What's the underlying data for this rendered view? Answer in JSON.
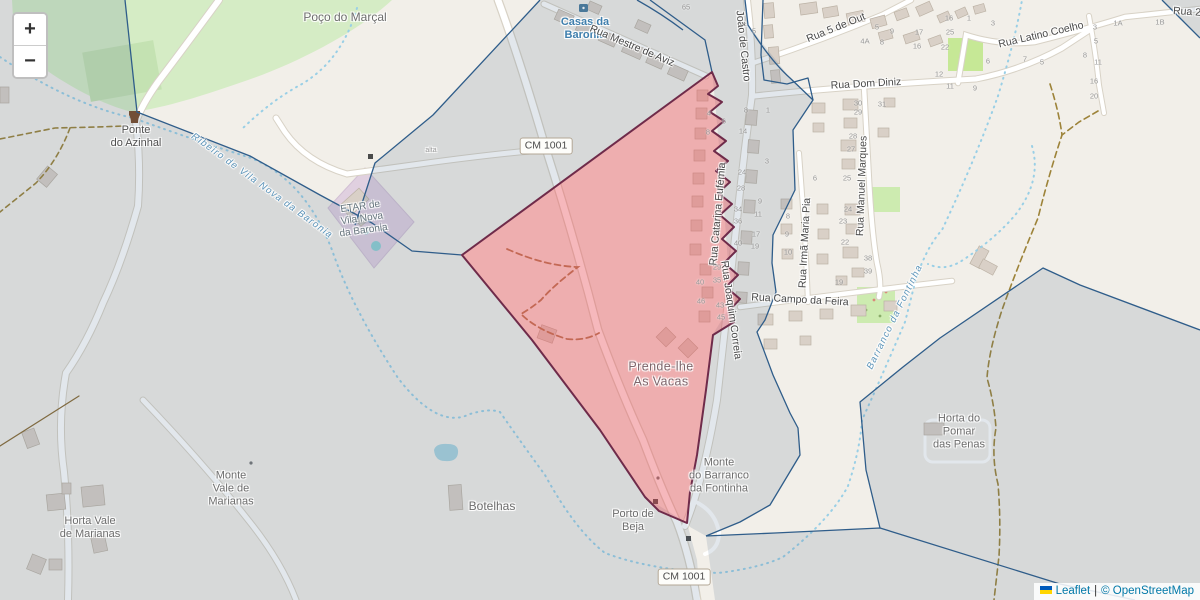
{
  "zoom_control": {
    "zoom_in": "+",
    "zoom_out": "−"
  },
  "attribution": {
    "leaflet_link": "Leaflet",
    "separator": "|",
    "osm_link": "© OpenStreetMap"
  },
  "colors": {
    "selected_fill": "#e74d57",
    "selected_stroke": "#6f2b4a",
    "boundary": "#2f5d8a",
    "tint": "rgba(77,107,137,0.16)",
    "water": "#99cfe6",
    "link": "#0078A8",
    "flag_blue": "#005BBB",
    "flag_yellow": "#FFD500"
  },
  "labels": [
    {
      "name": "poco-do-marcal",
      "text": "Poço do Marçal",
      "x": 345,
      "y": 17,
      "cls": "place"
    },
    {
      "name": "ponte-do-azinhal",
      "text": "Ponte\ndo Azinhal",
      "x": 136,
      "y": 137,
      "cls": "place-sm dark"
    },
    {
      "name": "casas-da-baronia",
      "text": "Casas da\nBaronia",
      "x": 585,
      "y": 29,
      "cls": "water-place"
    },
    {
      "name": "prende-lhe-as-vacas",
      "text": "Prende-lhe\nAs Vacas",
      "x": 661,
      "y": 374,
      "cls": "area"
    },
    {
      "name": "monte-do-barranco-da-fontinha",
      "text": "Monte\ndo Barranco\nda Fontinha",
      "x": 719,
      "y": 476,
      "cls": "place-sm"
    },
    {
      "name": "porto-de-beja",
      "text": "Porto de\nBeja",
      "x": 633,
      "y": 521,
      "cls": "place-sm"
    },
    {
      "name": "botelhas",
      "text": "Botelhas",
      "x": 492,
      "y": 506,
      "cls": "place"
    },
    {
      "name": "monte-vale-de-marianas",
      "text": "Monte\nVale de\nMarianas",
      "x": 231,
      "y": 489,
      "cls": "place-sm"
    },
    {
      "name": "horta-vale-de-marianas",
      "text": "Horta Vale\nde Marianas",
      "x": 90,
      "y": 528,
      "cls": "place-sm"
    },
    {
      "name": "horta-do-pomar-das-penas",
      "text": "Horta do\nPomar\ndas Penas",
      "x": 959,
      "y": 432,
      "cls": "place-sm"
    },
    {
      "name": "etar-de-vila-nova-da-baronia",
      "text": "ETAR de\nVila Nova\nda Baronia",
      "x": 362,
      "y": 219,
      "cls": "etar",
      "rot": -8
    },
    {
      "name": "ribeiro-de-vila-nova-da-baronia",
      "text": "Ribeiro de Vila Nova da Baronia",
      "x": 262,
      "y": 186,
      "cls": "water",
      "rot": 36
    },
    {
      "name": "barranco-da-fontinha",
      "text": "Barranco da Fontinha",
      "x": 895,
      "y": 317,
      "cls": "water",
      "rot": -64
    },
    {
      "name": "rua-mestre-de-aviz",
      "text": "Rua Mestre de Aviz",
      "x": 632,
      "y": 46,
      "cls": "street",
      "rot": 23
    },
    {
      "name": "rua-joao-de-castro",
      "text": "João de Castro",
      "x": 743,
      "y": 46,
      "cls": "street",
      "rot": 84
    },
    {
      "name": "rua-5-de-outubro",
      "text": "Rua 5 de Out",
      "x": 836,
      "y": 28,
      "cls": "street",
      "rot": -22
    },
    {
      "name": "rua-dom-diniz",
      "text": "Rua Dom Diniz",
      "x": 866,
      "y": 84,
      "cls": "street",
      "rot": -3
    },
    {
      "name": "rua-latino-coelho",
      "text": "Rua Latino Coelho",
      "x": 1041,
      "y": 35,
      "cls": "street",
      "rot": -13
    },
    {
      "name": "rua-2",
      "text": "Rua 2",
      "x": 1187,
      "y": 12,
      "cls": "street",
      "rot": 4
    },
    {
      "name": "rua-catarina-eufemia",
      "text": "Rua Catarina Eufémia",
      "x": 718,
      "y": 214,
      "cls": "street",
      "rot": -85
    },
    {
      "name": "rua-joaquim-correia",
      "text": "Rua Joaquim Correia",
      "x": 731,
      "y": 310,
      "cls": "street",
      "rot": 82
    },
    {
      "name": "rua-irma-maria-pia",
      "text": "Rua Irmã Maria Pia",
      "x": 805,
      "y": 243,
      "cls": "street",
      "rot": -87
    },
    {
      "name": "rua-manuel-marques",
      "text": "Rua Manuel Marques",
      "x": 862,
      "y": 186,
      "cls": "street",
      "rot": -88
    },
    {
      "name": "rua-campo-da-feira",
      "text": "Rua Campo da Feira",
      "x": 800,
      "y": 300,
      "cls": "street",
      "rot": 3
    },
    {
      "name": "path-label-alta",
      "text": "alta",
      "x": 431,
      "y": 151,
      "cls": "tiny"
    },
    {
      "name": "road-shield-cm1001-north",
      "text": "CM 1001",
      "x": 546,
      "y": 146,
      "cls": "shield"
    },
    {
      "name": "road-shield-cm1001-south",
      "text": "CM 1001",
      "x": 684,
      "y": 577,
      "cls": "shield"
    }
  ],
  "house_numbers": [
    {
      "t": "65",
      "x": 686,
      "y": 8
    },
    {
      "t": "5",
      "x": 754,
      "y": 32
    },
    {
      "t": "4A",
      "x": 865,
      "y": 42
    },
    {
      "t": "4",
      "x": 709,
      "y": 114
    },
    {
      "t": "6",
      "x": 724,
      "y": 122
    },
    {
      "t": "8",
      "x": 708,
      "y": 133
    },
    {
      "t": "14",
      "x": 743,
      "y": 132
    },
    {
      "t": "8",
      "x": 746,
      "y": 111
    },
    {
      "t": "1",
      "x": 768,
      "y": 111
    },
    {
      "t": "3",
      "x": 767,
      "y": 162
    },
    {
      "t": "24",
      "x": 742,
      "y": 173
    },
    {
      "t": "28",
      "x": 741,
      "y": 189
    },
    {
      "t": "9",
      "x": 760,
      "y": 202
    },
    {
      "t": "11",
      "x": 758,
      "y": 215
    },
    {
      "t": "34",
      "x": 738,
      "y": 210
    },
    {
      "t": "36",
      "x": 738,
      "y": 222
    },
    {
      "t": "17",
      "x": 756,
      "y": 235
    },
    {
      "t": "19",
      "x": 755,
      "y": 247
    },
    {
      "t": "40",
      "x": 738,
      "y": 244
    },
    {
      "t": "8",
      "x": 788,
      "y": 217
    },
    {
      "t": "9",
      "x": 787,
      "y": 235
    },
    {
      "t": "10",
      "x": 788,
      "y": 253
    },
    {
      "t": "29",
      "x": 717,
      "y": 268
    },
    {
      "t": "35",
      "x": 717,
      "y": 281
    },
    {
      "t": "40",
      "x": 700,
      "y": 283
    },
    {
      "t": "46",
      "x": 701,
      "y": 302
    },
    {
      "t": "43",
      "x": 720,
      "y": 306
    },
    {
      "t": "45",
      "x": 721,
      "y": 318
    },
    {
      "t": "6",
      "x": 815,
      "y": 179
    },
    {
      "t": "25",
      "x": 847,
      "y": 179
    },
    {
      "t": "30",
      "x": 858,
      "y": 104
    },
    {
      "t": "29",
      "x": 858,
      "y": 113
    },
    {
      "t": "28",
      "x": 853,
      "y": 137
    },
    {
      "t": "27",
      "x": 851,
      "y": 150
    },
    {
      "t": "24",
      "x": 848,
      "y": 210
    },
    {
      "t": "23",
      "x": 843,
      "y": 222
    },
    {
      "t": "22",
      "x": 845,
      "y": 243
    },
    {
      "t": "19",
      "x": 839,
      "y": 283
    },
    {
      "t": "38",
      "x": 868,
      "y": 259
    },
    {
      "t": "39",
      "x": 868,
      "y": 272
    },
    {
      "t": "31",
      "x": 882,
      "y": 105
    },
    {
      "t": "16",
      "x": 949,
      "y": 19
    },
    {
      "t": "25",
      "x": 950,
      "y": 33
    },
    {
      "t": "22",
      "x": 945,
      "y": 48
    },
    {
      "t": "17",
      "x": 919,
      "y": 33
    },
    {
      "t": "9",
      "x": 892,
      "y": 32
    },
    {
      "t": "5",
      "x": 877,
      "y": 28
    },
    {
      "t": "8",
      "x": 882,
      "y": 43
    },
    {
      "t": "16",
      "x": 917,
      "y": 47
    },
    {
      "t": "12",
      "x": 939,
      "y": 75
    },
    {
      "t": "11",
      "x": 950,
      "y": 87
    },
    {
      "t": "9",
      "x": 975,
      "y": 89
    },
    {
      "t": "1",
      "x": 969,
      "y": 19
    },
    {
      "t": "3",
      "x": 993,
      "y": 24
    },
    {
      "t": "6",
      "x": 988,
      "y": 62
    },
    {
      "t": "7",
      "x": 1025,
      "y": 60
    },
    {
      "t": "5",
      "x": 1042,
      "y": 63
    },
    {
      "t": "8",
      "x": 1085,
      "y": 56
    },
    {
      "t": "3",
      "x": 1095,
      "y": 28
    },
    {
      "t": "5",
      "x": 1096,
      "y": 42
    },
    {
      "t": "1A",
      "x": 1118,
      "y": 24
    },
    {
      "t": "1B",
      "x": 1160,
      "y": 23
    },
    {
      "t": "11",
      "x": 1098,
      "y": 63
    },
    {
      "t": "16",
      "x": 1094,
      "y": 82
    },
    {
      "t": "20",
      "x": 1094,
      "y": 97
    }
  ]
}
